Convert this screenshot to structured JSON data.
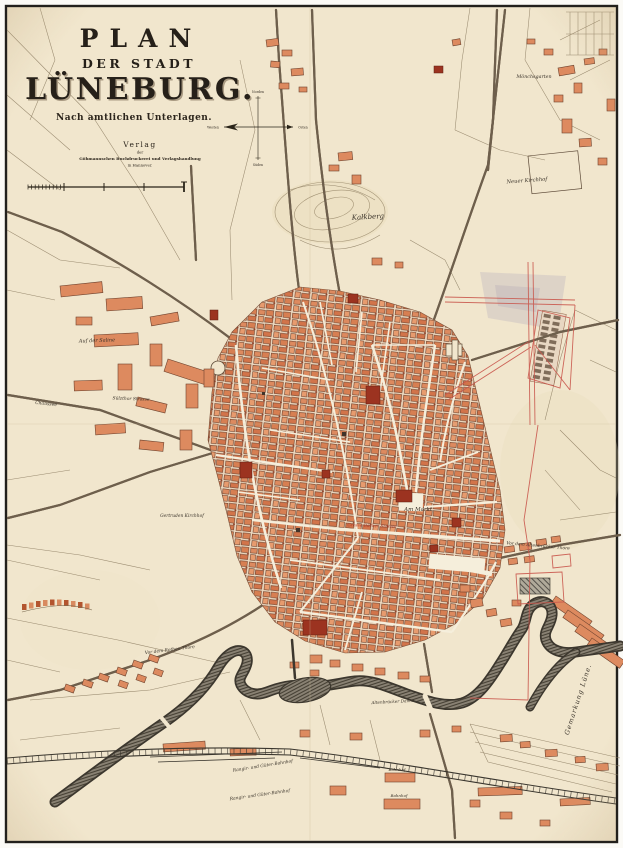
{
  "title": {
    "line1": "PLAN",
    "line2": "DER STADT",
    "line3": "LÜNEBURG.",
    "subtitle": "Nach amtlichen Unterlagen."
  },
  "publisher": {
    "line1": "Verlag",
    "line2": "der",
    "line3": "Göhmannschen Buchdruckerei und Verlagshandlung",
    "line4": "in Hannover."
  },
  "compass": {
    "north": "Norden",
    "south": "Süden",
    "east": "Osten",
    "west": "Westen"
  },
  "colors": {
    "paper": "#f1e6cd",
    "ink": "#2a2419",
    "building": "#dd8a5f",
    "building_dark": "#9c3320",
    "water": "#3c372e",
    "red_line": "#c9574d",
    "red_label": "#b03a2a"
  },
  "map": {
    "labels": [
      {
        "id": "kalkberg",
        "text": "Kalkberg",
        "x": 368,
        "y": 219,
        "size": 7,
        "rot": -3
      },
      {
        "id": "moenchsgarten",
        "text": "Mönchsgarten",
        "x": 534,
        "y": 78,
        "size": 4.8,
        "rot": 0
      },
      {
        "id": "neuer-kirchhof",
        "text": "Neuer Kirchhof",
        "x": 527,
        "y": 182,
        "size": 5.2,
        "rot": -4
      },
      {
        "id": "auf-der-saline",
        "text": "Auf der Saline",
        "x": 97,
        "y": 342,
        "size": 5,
        "rot": -2
      },
      {
        "id": "chaussee",
        "text": "Chaussee",
        "x": 46,
        "y": 405,
        "size": 4.5,
        "rot": 6
      },
      {
        "id": "suelzthor-strasse",
        "text": "Sülzthor Strasse",
        "x": 131,
        "y": 400,
        "size": 4.4,
        "rot": 2
      },
      {
        "id": "gertruden-kirchhof",
        "text": "Gertruden Kirchhof",
        "x": 182,
        "y": 517,
        "size": 4.4,
        "rot": 0
      },
      {
        "id": "am-markt",
        "text": "Am Markt.",
        "x": 419,
        "y": 511,
        "size": 5.5,
        "rot": 0
      },
      {
        "id": "grosse-baecker-strasse",
        "text": "Grosse Bäcker Strasse",
        "x": 372,
        "y": 527,
        "size": 4.3,
        "rot": 2,
        "color": "red"
      },
      {
        "id": "vor-dem-altenbruecker-thore",
        "text": "Vor dem Altenbrücker Thore",
        "x": 538,
        "y": 547,
        "size": 4.4,
        "rot": 5
      },
      {
        "id": "altenbruecker-damm",
        "text": "Altenbrücker Damm",
        "x": 393,
        "y": 703,
        "size": 4.2,
        "rot": -3
      },
      {
        "id": "vor-dem-rothen-thore",
        "text": "Vor dem Rothen Thore",
        "x": 170,
        "y": 651,
        "size": 4.4,
        "rot": -7
      },
      {
        "id": "rangir-gueter-bahnhof-1",
        "text": "Rangir- und Güter-Bahnhof",
        "x": 263,
        "y": 767,
        "size": 4.4,
        "rot": -9
      },
      {
        "id": "rangir-gueter-bahnhof-2",
        "text": "Rangir- und Güter-Bahnhof",
        "x": 260,
        "y": 796,
        "size": 4.4,
        "rot": -8
      },
      {
        "id": "bahnhof-1",
        "text": "Bahnhof",
        "x": 397,
        "y": 771,
        "size": 4,
        "rot": 0
      },
      {
        "id": "bahnhof-2",
        "text": "Bahnhof",
        "x": 399,
        "y": 797,
        "size": 4,
        "rot": 0
      },
      {
        "id": "gemarkung-luene",
        "text": "Gemarkung Lüne.",
        "x": 580,
        "y": 700,
        "size": 6.5,
        "rot": -72,
        "spacing": 1
      }
    ]
  }
}
